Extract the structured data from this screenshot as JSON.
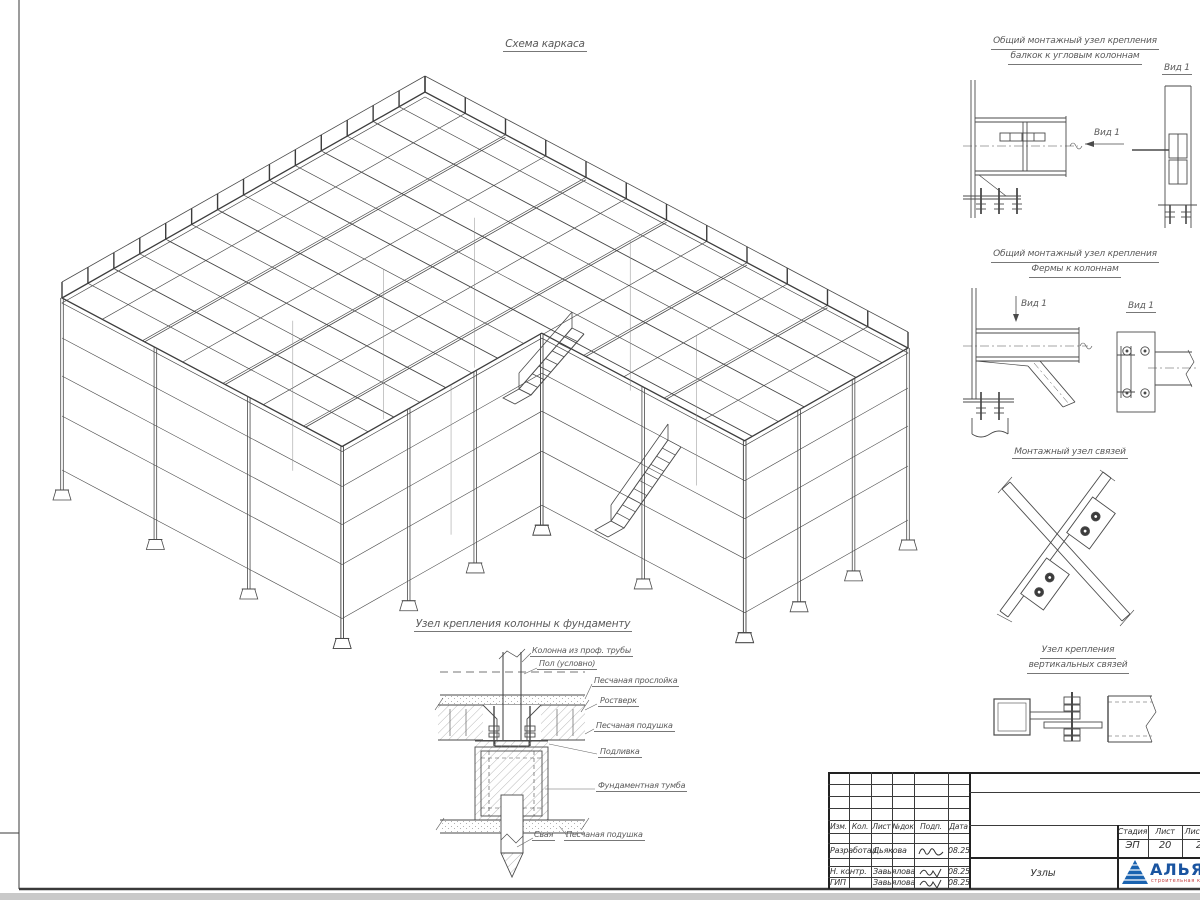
{
  "page": {
    "line_color": "#4a4a4a",
    "outside_bg": "#c9c9c9"
  },
  "main_view": {
    "title": "Схема каркаса"
  },
  "details": {
    "d1": {
      "title_line1": "Общий монтажный узел крепления",
      "title_line2": "балкок к угловым колоннам",
      "arrow_view_label": "Вид 1",
      "view_label": "Вид 1"
    },
    "d2": {
      "title_line1": "Общий монтажный узел крепления",
      "title_line2": "Фермы к колоннам",
      "arrow_view_label": "Вид 1",
      "view_label": "Вид 1"
    },
    "d3": {
      "title": "Монтажный узел связей"
    },
    "d4": {
      "title_line1": "Узел крепления",
      "title_line2": "вертикальных связей"
    }
  },
  "foundation": {
    "title": "Узел крепления колонны к фундаменту",
    "labels": [
      "Колонна из проф. трубы",
      "Пол (условно)",
      "Песчаная прослойка",
      "Ростверк",
      "Песчаная подушка",
      "Подливка",
      "Фундаментная тумба",
      "Свая",
      "Песчаная подушка"
    ]
  },
  "title_block": {
    "headers": [
      "Изм.",
      "Кол.",
      "Лист",
      "№док",
      "Подп.",
      "Дата"
    ],
    "rows": [
      {
        "role": "Разработал",
        "name": "Дьякова",
        "date": "08.25"
      },
      {
        "role": "Н. контр.",
        "name": "Завьялова",
        "date": "08.25"
      },
      {
        "role": "ГИП",
        "name": "Завьялова",
        "date": "08.25"
      }
    ],
    "stage_label": "Стадия",
    "stage_value": "ЭП",
    "sheet_label": "Лист",
    "sheet_value": "20",
    "sheets_label": "Листов",
    "sheets_value": "2",
    "doc_title": "Узлы",
    "company_name": "АЛЬЯНС",
    "company_tagline": "строительная компания"
  }
}
